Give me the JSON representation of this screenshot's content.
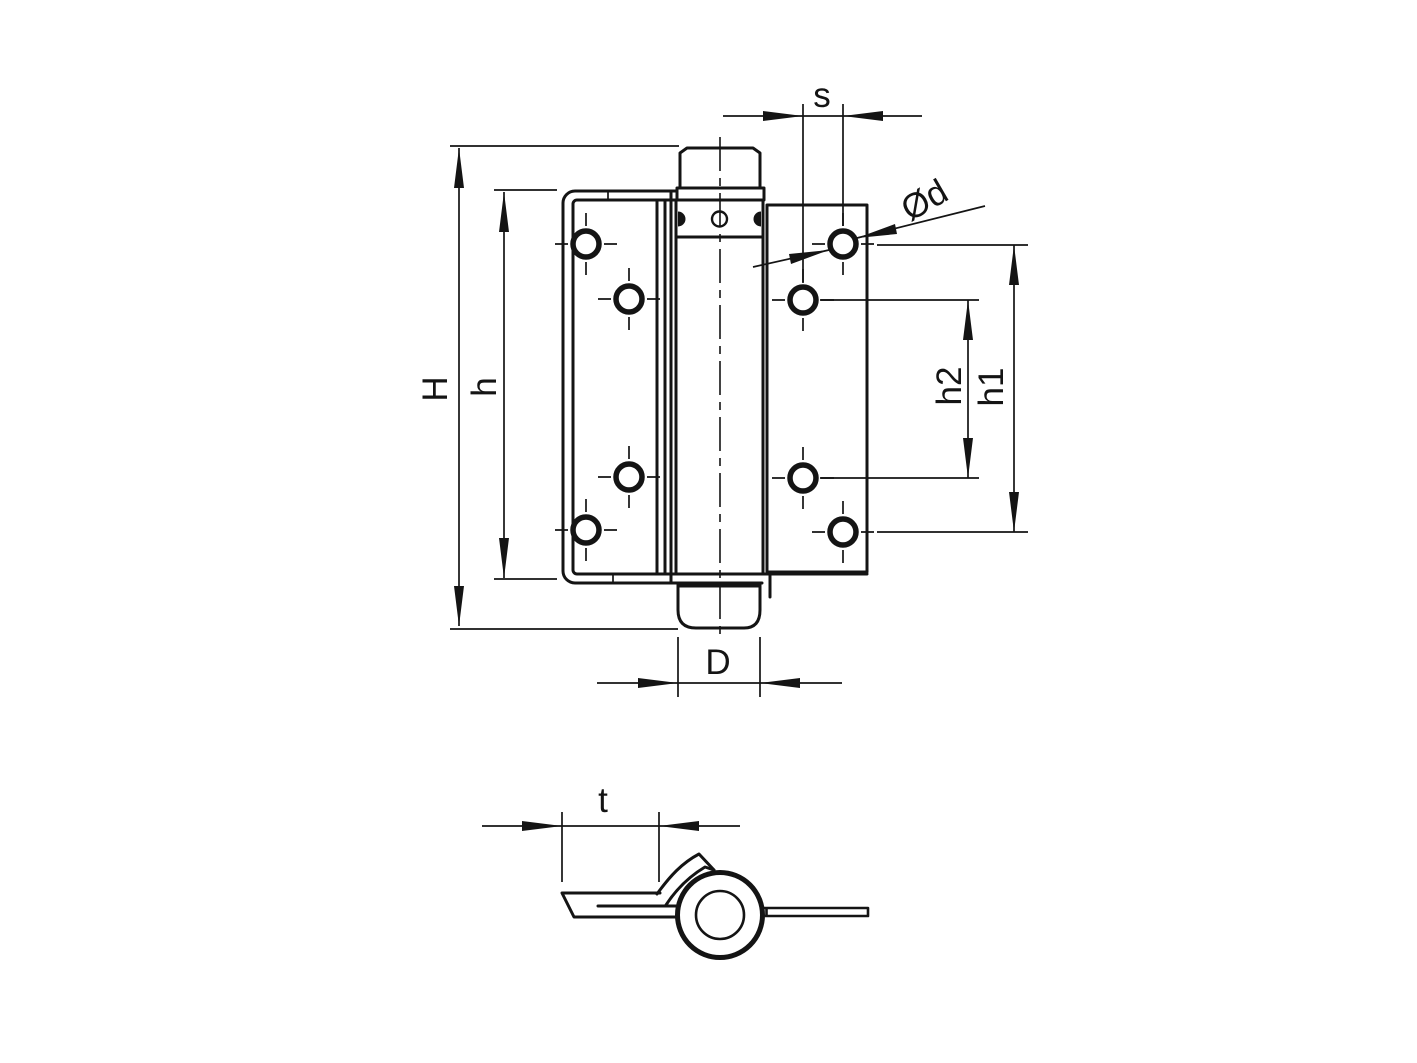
{
  "canvas": {
    "background": "#ffffff",
    "line_color": "#141414"
  },
  "front_view": {
    "description": "hinge front elevation",
    "labels": {
      "H": "H",
      "h": "h",
      "s": "s",
      "d": "Ød",
      "h2": "h2",
      "h1": "h1",
      "D": "D"
    }
  },
  "side_view": {
    "description": "hinge profile with knuckle",
    "labels": {
      "t": "t"
    }
  }
}
